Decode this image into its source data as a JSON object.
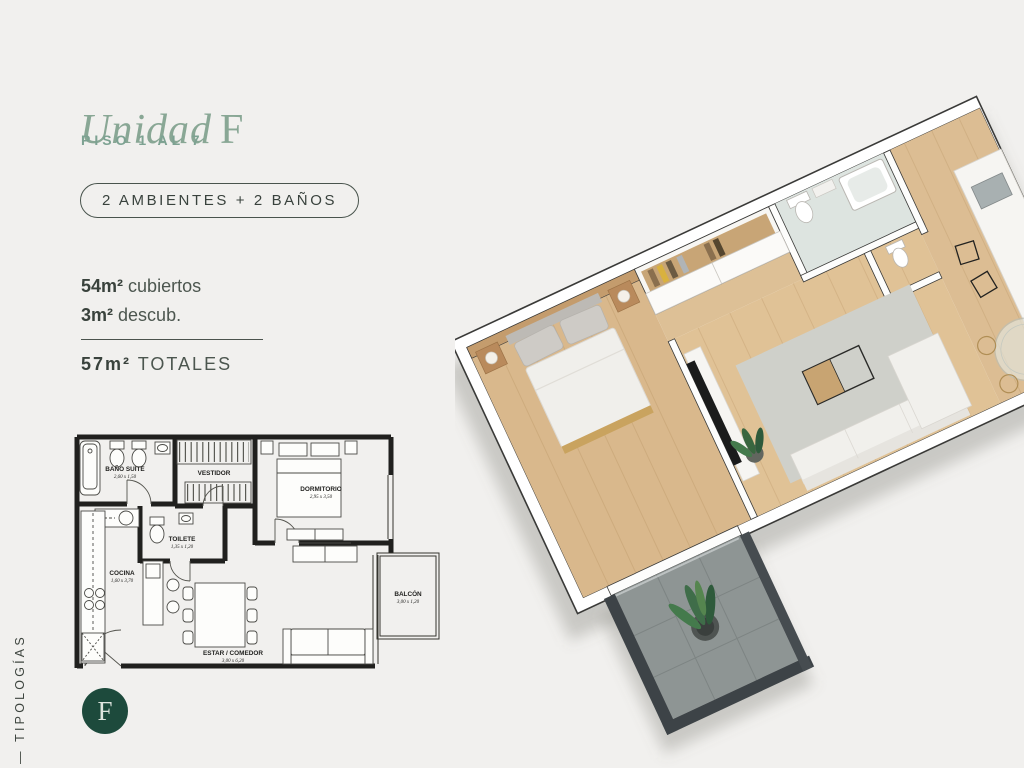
{
  "page": {
    "colors": {
      "background": "#f1f0ee",
      "accent_green": "#89a795",
      "dark_green": "#1d4a3c",
      "text_dark": "#39423d",
      "wood_floor": "#dcbd93",
      "balcony_concrete": "#8e9594",
      "charcoal_wall": "#3d4347"
    }
  },
  "header": {
    "title": "Unidad",
    "unit": "F",
    "floors": "PISO 1 AL 7",
    "badge": "2 AMBIENTES + 2 BAÑOS"
  },
  "areas": {
    "covered": {
      "value": "54m²",
      "label": "cubiertos"
    },
    "uncovered": {
      "value": "3m²",
      "label": "descub."
    },
    "total": {
      "value": "57m²",
      "label": "TOTALES"
    }
  },
  "floorplan": {
    "rooms": [
      {
        "name": "BAÑO SUITE",
        "dims": "2,60 x 1,50"
      },
      {
        "name": "VESTIDOR",
        "dims": ""
      },
      {
        "name": "DORMITORIO",
        "dims": "2,95 x 3,50"
      },
      {
        "name": "TOILETE",
        "dims": "1,35 x 1,20"
      },
      {
        "name": "COCINA",
        "dims": "1,60 x 3,70"
      },
      {
        "name": "ESTAR / COMEDOR",
        "dims": "3,00 x 6,20"
      },
      {
        "name": "BALCÓN",
        "dims": "3,00 x 1,20"
      }
    ]
  },
  "sidebar": {
    "vertical_label": "— TIPOLOGÍAS",
    "unit_badge": "F"
  }
}
